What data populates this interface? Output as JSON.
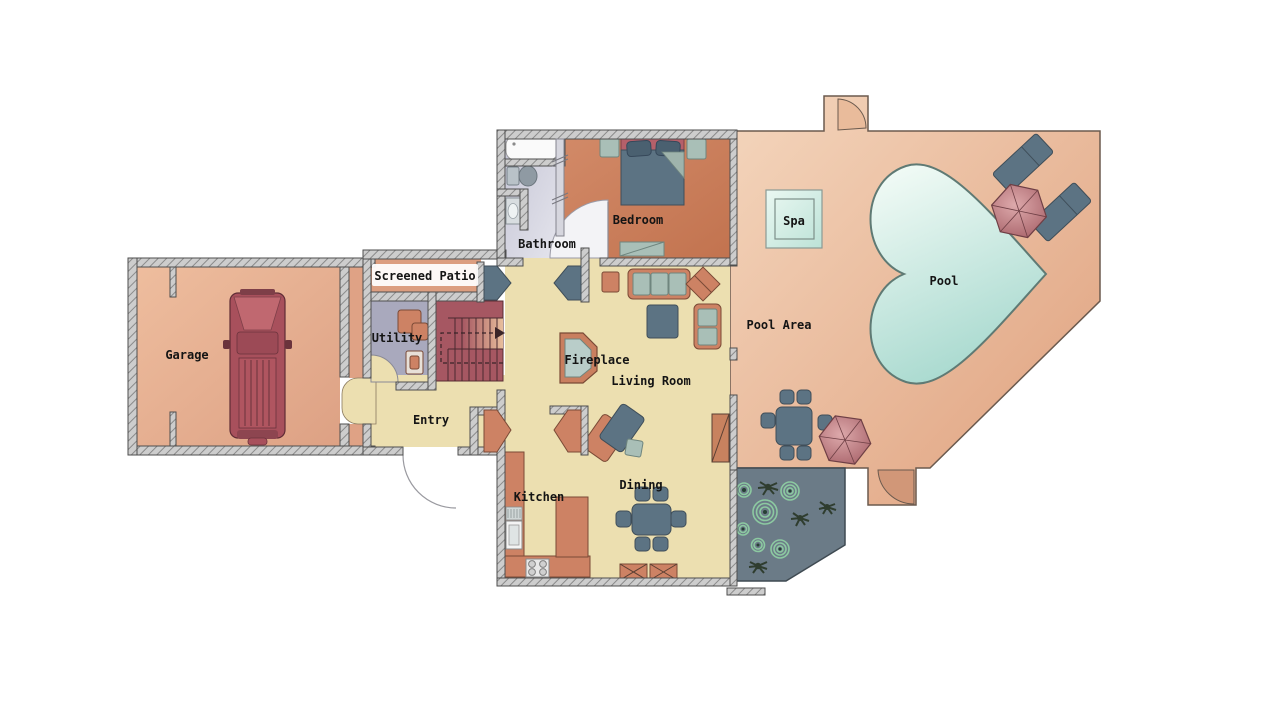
{
  "title": "House Floor Plan",
  "type": "floor_plan",
  "rooms": {
    "garage": {
      "label": "Garage"
    },
    "screened_patio": {
      "label": "Screened Patio"
    },
    "utility": {
      "label": "Utility"
    },
    "entry": {
      "label": "Entry"
    },
    "kitchen": {
      "label": "Kitchen"
    },
    "living_room": {
      "label": "Living Room"
    },
    "fireplace": {
      "label": "Fireplace"
    },
    "dining": {
      "label": "Dining"
    },
    "bathroom": {
      "label": "Bathroom"
    },
    "bedroom": {
      "label": "Bedroom"
    },
    "pool_area": {
      "label": "Pool Area"
    },
    "pool": {
      "label": "Pool"
    },
    "spa": {
      "label": "Spa"
    }
  },
  "features": [
    "heart-shaped pool",
    "spa",
    "two patio umbrellas",
    "two lounge chairs",
    "outdoor dining set",
    "garden with plants",
    "pickup truck in garage",
    "staircase",
    "fireplace",
    "kitchen counters with sink and stove",
    "dining table with six chairs",
    "bed with nightstands",
    "bathtub, toilet and sink"
  ],
  "colors": {
    "wall_fill": "#cdcdcd",
    "wall_hatch": "#8a8a8a",
    "wall_edge": "#4e4e4e",
    "garage_floor": "#e3aa8c",
    "patio_floor": "#dc9e80",
    "utility_floor": "#a9a9bd",
    "stairs": "#a65762",
    "stairs_light": "#e6bb97",
    "cream_floor": "#ecdfb0",
    "bathroom_floor": "#ccccda",
    "bedroom_floor": "#c87d5c",
    "pool_deck": "#e7b693",
    "pool_water_light": "#eef9f4",
    "pool_water_dark": "#9fd5ca",
    "garden": "#6b7b87",
    "plant_spiral_green": "#8cc9a1",
    "plant_dark": "#2f3d2f",
    "furniture_slate": "#5c7383",
    "furniture_sage": "#a9bfb7",
    "furniture_salmon": "#cd8264",
    "car_body": "#a8505c",
    "car_hood": "#c06870",
    "umbrella_pink": "#c8868c",
    "bed_headboard": "#b5606a"
  }
}
